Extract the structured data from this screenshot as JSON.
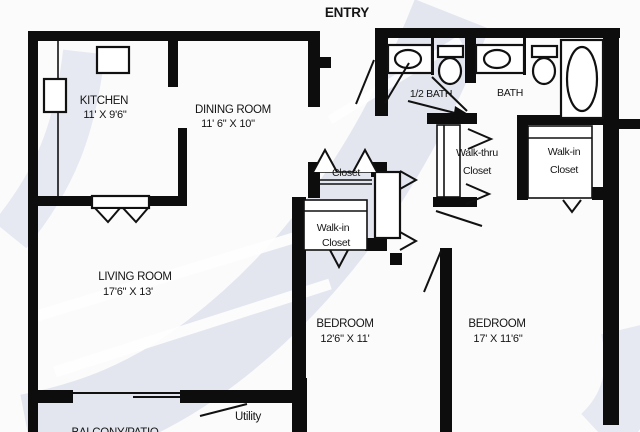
{
  "colors": {
    "wall": "#0d0d0d",
    "text": "#151515",
    "watermark": "#e3e6ef",
    "fixture_fill": "#ffffff",
    "background": "#fbfbfc"
  },
  "labels": {
    "entry": "ENTRY",
    "kitchen": {
      "name": "KITCHEN",
      "dims": "11' X 9'6\""
    },
    "dining": {
      "name": "DINING ROOM",
      "dims": "11' 6\" X 10\""
    },
    "half_bath": "1/2 BATH",
    "bath": "BATH",
    "walk_thru_closet": {
      "line1": "Walk-thru",
      "line2": "Closet"
    },
    "walk_in_closet_right": {
      "line1": "Walk-in",
      "line2": "Closet"
    },
    "closet": "Closet",
    "walk_in_closet_center": {
      "line1": "Walk-in",
      "line2": "Closet"
    },
    "living": {
      "name": "LIVING ROOM",
      "dims": "17'6\" X 13'"
    },
    "bedroom_center": {
      "name": "BEDROOM",
      "dims": "12'6\" X 11'"
    },
    "bedroom_right": {
      "name": "BEDROOM",
      "dims": "17' X 11'6\""
    },
    "utility": "Utility",
    "balcony": "BALCONY/PATIO"
  }
}
